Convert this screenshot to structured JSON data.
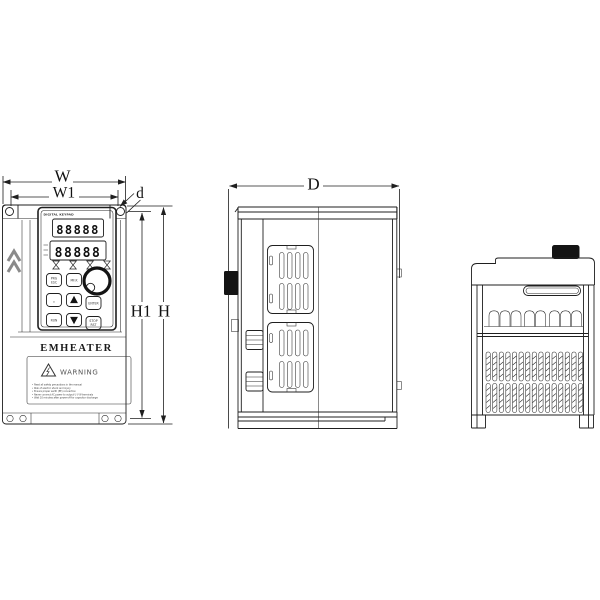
{
  "dimensions": {
    "w": "W",
    "w1": "W1",
    "d": "d",
    "depth": "D",
    "h1": "H1",
    "h": "H"
  },
  "front": {
    "keypad_header": "DIGITAL KEYPAD",
    "display_row1": "88888",
    "display_row2": "88888",
    "brand": "EMHEATER",
    "warning_title": "WARNING",
    "warning_lines": [
      "• Read all safety precautions in the manual",
      "• Risk of electric shock and injury",
      "• Ensure proper earth (PE) connection",
      "• Never connect AC power to output U V W terminals",
      "• Wait 10 minutes after power-off for capacitor discharge"
    ],
    "buttons": {
      "prg_top": "PRG",
      "prg_bottom": "ESC",
      "mfk": "MF.K",
      "shift": "»",
      "enter": "ENTER",
      "run": "RUN",
      "stop_top": "STOP",
      "stop_bottom": "RST"
    }
  }
}
